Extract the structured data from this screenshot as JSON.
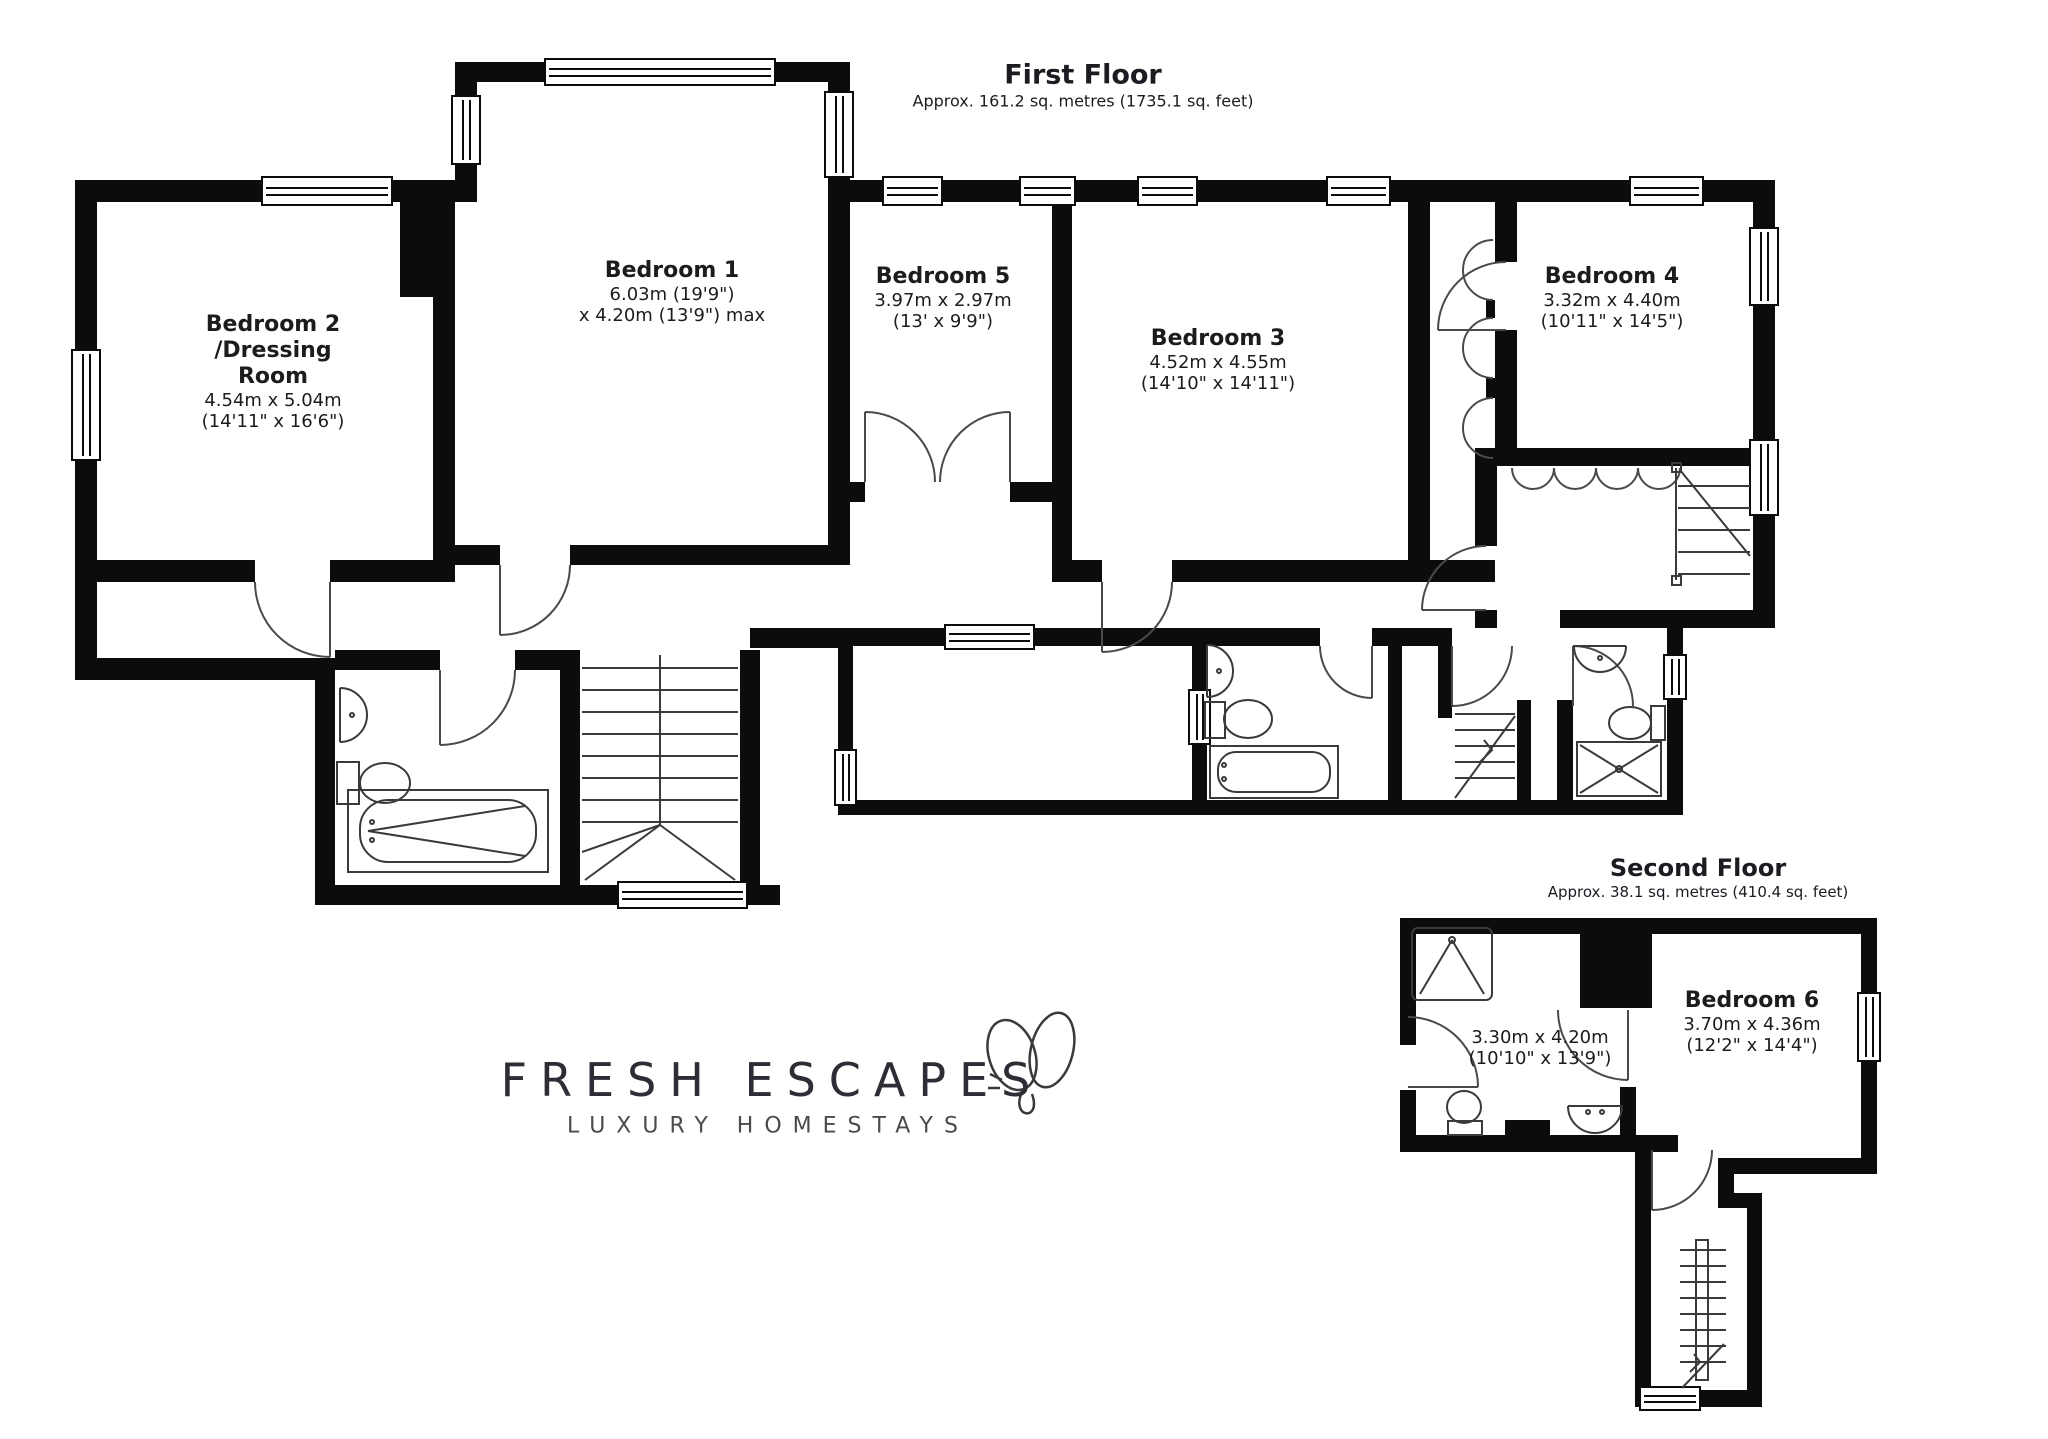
{
  "colors": {
    "wall": "#0c0c0c",
    "line": "#3a3a3a",
    "text": "#1c1c1c"
  },
  "first_floor": {
    "title": "First Floor",
    "area": "Approx. 161.2 sq. metres (1735.1 sq. feet)",
    "rooms": {
      "bedroom2": {
        "line1": "Bedroom 2",
        "line2": "/Dressing",
        "line3": "Room",
        "metric": "4.54m x 5.04m",
        "imperial": "(14'11\" x 16'6\")"
      },
      "bedroom1": {
        "name": "Bedroom 1",
        "metric": "6.03m (19'9\")",
        "imperial": "x 4.20m (13'9\") max"
      },
      "bedroom5": {
        "name": "Bedroom 5",
        "metric": "3.97m x 2.97m",
        "imperial": "(13' x 9'9\")"
      },
      "bedroom3": {
        "name": "Bedroom 3",
        "metric": "4.52m x 4.55m",
        "imperial": "(14'10\" x 14'11\")"
      },
      "bedroom4": {
        "name": "Bedroom 4",
        "metric": "3.32m x 4.40m",
        "imperial": "(10'11\" x 14'5\")"
      }
    }
  },
  "second_floor": {
    "title": "Second Floor",
    "area": "Approx. 38.1 sq. metres (410.4 sq. feet)",
    "rooms": {
      "bathroom": {
        "metric": "3.30m x 4.20m",
        "imperial": "(10'10\" x 13'9\")"
      },
      "bedroom6": {
        "name": "Bedroom 6",
        "metric": "3.70m x 4.36m",
        "imperial": "(12'2\" x 14'4\")"
      }
    }
  },
  "logo": {
    "name": "FRESH ESCAPES",
    "tagline": "LUXURY HOMESTAYS"
  }
}
